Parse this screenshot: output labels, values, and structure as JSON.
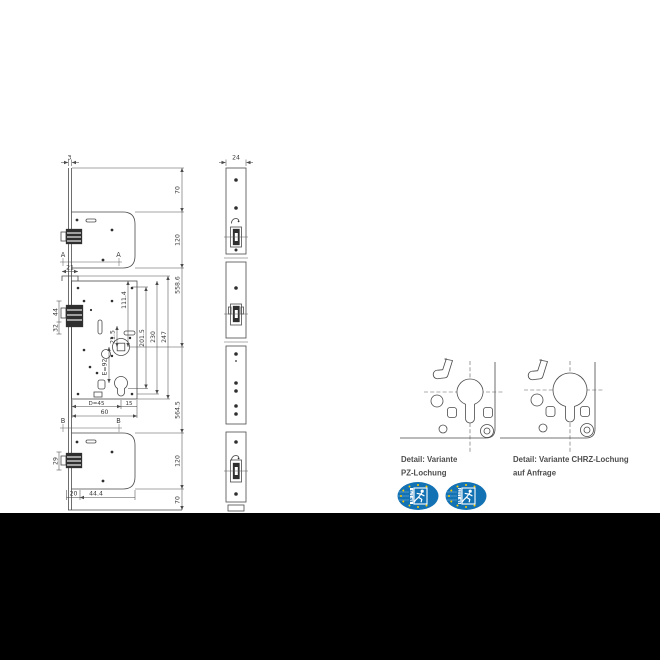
{
  "document": {
    "background": "#ffffff",
    "letterbox_color": "#000000"
  },
  "colors": {
    "line": "#4a4a4a",
    "dim_text": "#3a3a3a",
    "caption_text": "#4d4d4d",
    "badge_blue": "#1372b4",
    "badge_yellow": "#f8c800"
  },
  "front_view": {
    "dims": {
      "rail_width": "3",
      "top_offset": "70",
      "top_case_height": "120",
      "upper_span": "558.6",
      "step_width": "21",
      "latch_upper": "44",
      "latch_lower": "32",
      "follower_top": "111.4",
      "cyl_gap": "21.5",
      "inner_height": "201.5",
      "mid_height": "230",
      "case_height": "247",
      "entry": "E=92",
      "backset": "D=45",
      "back_edge": "15",
      "case_width": "60",
      "lower_span": "564.5",
      "bottom_case_height": "120",
      "bottom_offset": "70",
      "bottom_latch": "29",
      "bottom_left": "20",
      "bottom_width": "44.4"
    },
    "section_labels": {
      "a": "A",
      "b": "B"
    }
  },
  "side_view": {
    "dims": {
      "profile_width": "24"
    }
  },
  "details": [
    {
      "caption_line1": "Detail: Variante",
      "caption_line2": "PZ-Lochung"
    },
    {
      "caption_line1": "Detail: Variante CHRZ-Lochung",
      "caption_line2": "auf Anfrage"
    }
  ],
  "badges": [
    {
      "standard": "EN 179"
    },
    {
      "standard": "EN 1125"
    }
  ]
}
